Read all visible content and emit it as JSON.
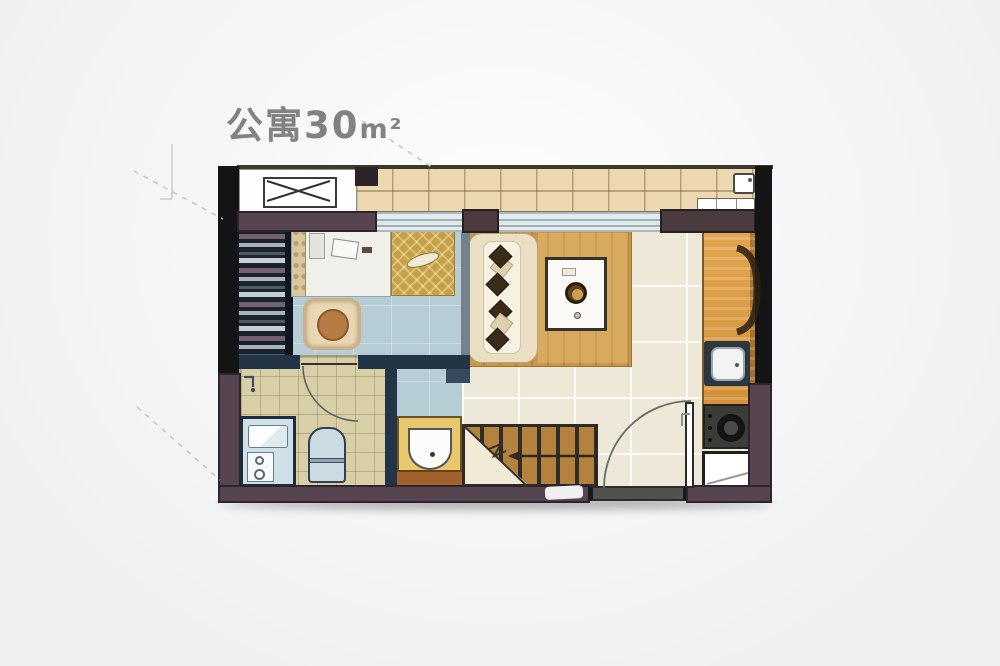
{
  "title": {
    "main": "公寓30",
    "unit": "m²"
  },
  "palette": {
    "bg_top": "#fdfdfd",
    "bg": "#eef0f2",
    "title_color": "#828282",
    "wall": "#564550",
    "wall_dark": "#141414",
    "wall_brown": "#4c3b3e",
    "wall_navy": "#243447",
    "divider": "#74818b",
    "balcony": "#ecd9af",
    "bedroom_floor": "#b6cdd5",
    "living_floor": "#ede8d8",
    "bath_floor": "#d9cfa6",
    "counter": "#d8973f",
    "wood_rug": "#c9964a",
    "stair": "#b5813f",
    "gold": "#c7a043",
    "vanity": "#e9c76d",
    "vanity_wood": "#a2622c",
    "sofa": "#eadfc2",
    "pillow": "#3a2b1b",
    "fixture_blue": "#cfe0e8",
    "toilet": "#cbdbe4",
    "navy_border": "#1d2c3e",
    "threshold": "#515150",
    "dash": "#c3c6ca"
  }
}
